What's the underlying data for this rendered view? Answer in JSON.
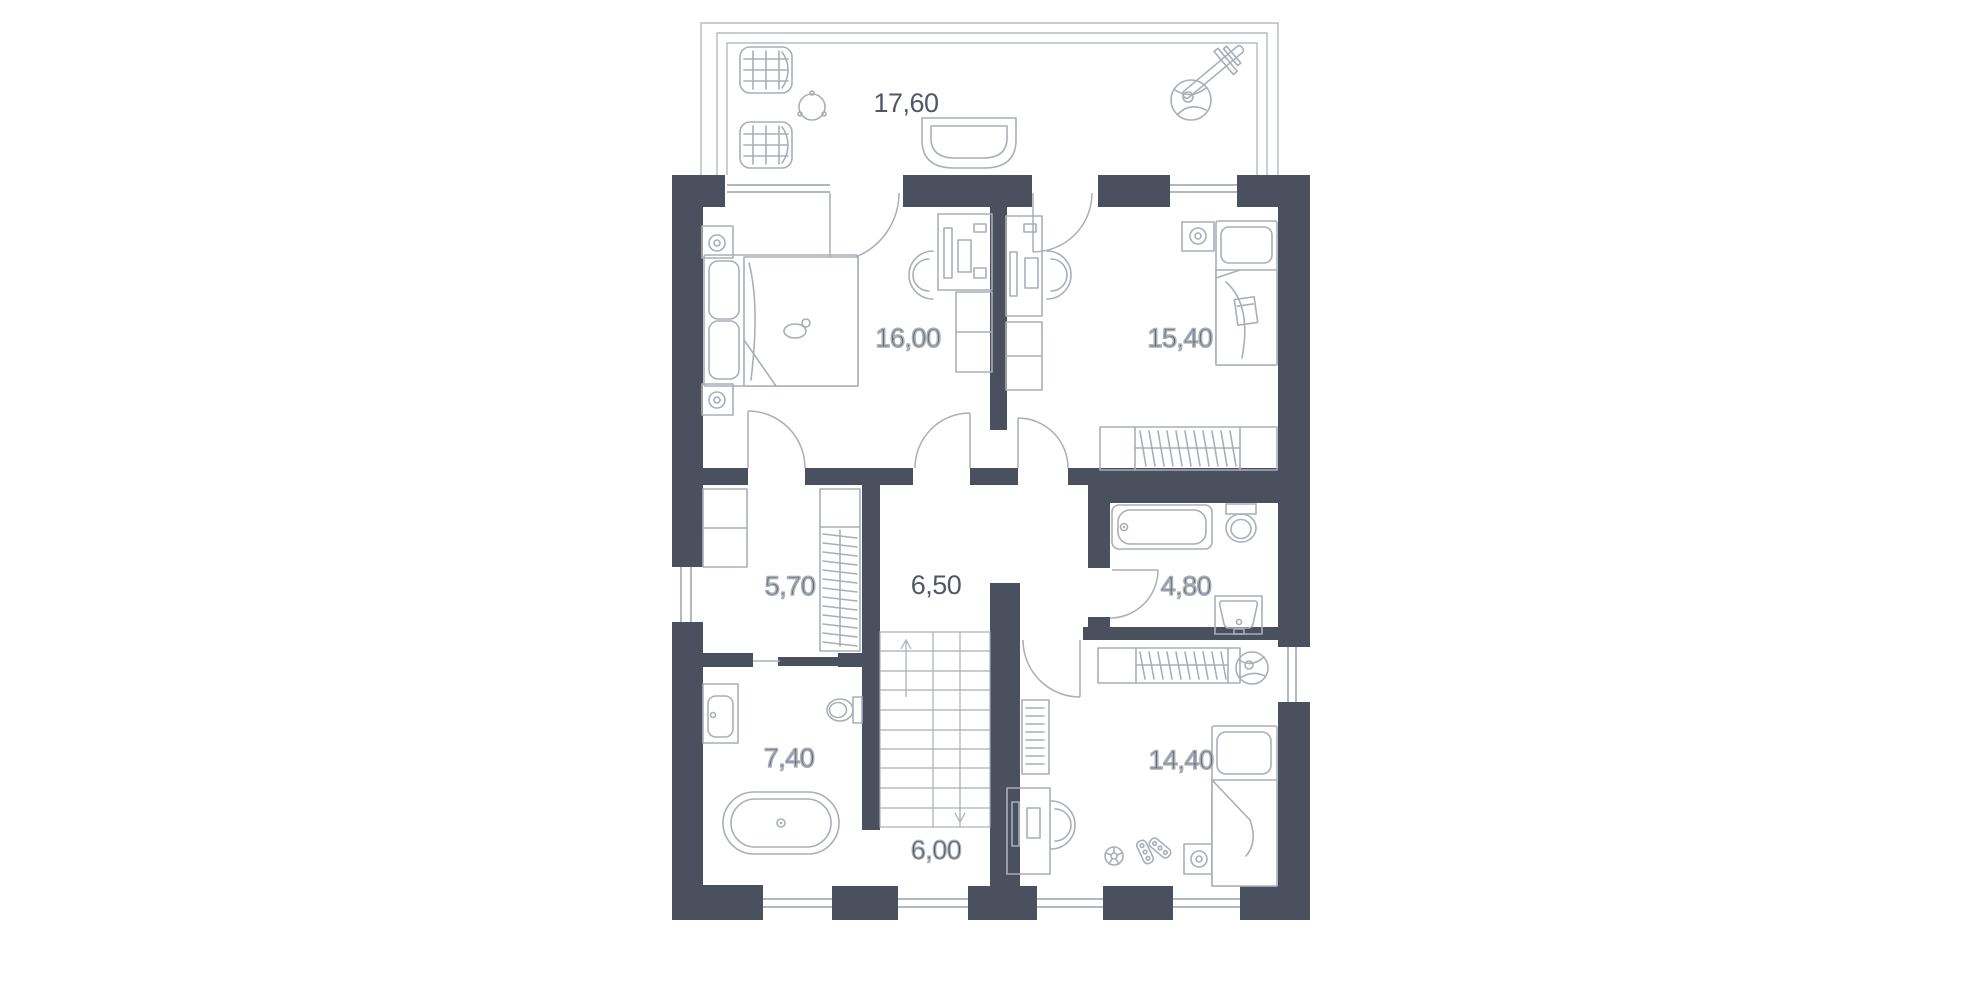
{
  "app": {
    "type": "floor-plan-drawing",
    "background": "#ffffff"
  },
  "floor_plan": {
    "colors": {
      "wall": "#4b505e",
      "furniture_line": "#a9aeb9",
      "window_line": "#9aa0ac",
      "label_text": "#515767"
    },
    "rooms": [
      {
        "id": "terrace",
        "area_label": "17,60",
        "furniture": [
          "wicker-chair",
          "wicker-chair",
          "round-side-table",
          "curved-bench",
          "potted-plant",
          "sun-lounger"
        ]
      },
      {
        "id": "bedroom-main",
        "area_label": "16,00",
        "furniture": [
          "double-bed",
          "nightstand-lamp",
          "nightstand-lamp",
          "desk",
          "desk-chair",
          "dresser",
          "cat"
        ]
      },
      {
        "id": "bedroom-second",
        "area_label": "15,40",
        "furniture": [
          "single-bed",
          "nightstand-lamp",
          "desk",
          "desk-chair",
          "dresser",
          "wardrobe",
          "notebook"
        ]
      },
      {
        "id": "walk-in-closet",
        "area_label": "5,70",
        "furniture": [
          "shelving-unit",
          "wardrobe"
        ]
      },
      {
        "id": "hallway",
        "area_label": "6,50",
        "furniture": []
      },
      {
        "id": "bathroom-small",
        "area_label": "4,80",
        "furniture": [
          "bathtub",
          "toilet",
          "washbasin"
        ]
      },
      {
        "id": "bathroom-large",
        "area_label": "7,40",
        "furniture": [
          "washbasin",
          "toilet",
          "freestanding-bathtub"
        ]
      },
      {
        "id": "staircase",
        "area_label": "6,00",
        "furniture": [
          "stairs-up-arrow",
          "stairs-down-arrow"
        ]
      },
      {
        "id": "bedroom-kids",
        "area_label": "14,40",
        "furniture": [
          "single-bed",
          "nightstand-lamp",
          "desk",
          "desk-chair",
          "bookshelf",
          "wardrobe",
          "potted-plant",
          "football",
          "roller-skates"
        ]
      }
    ]
  }
}
